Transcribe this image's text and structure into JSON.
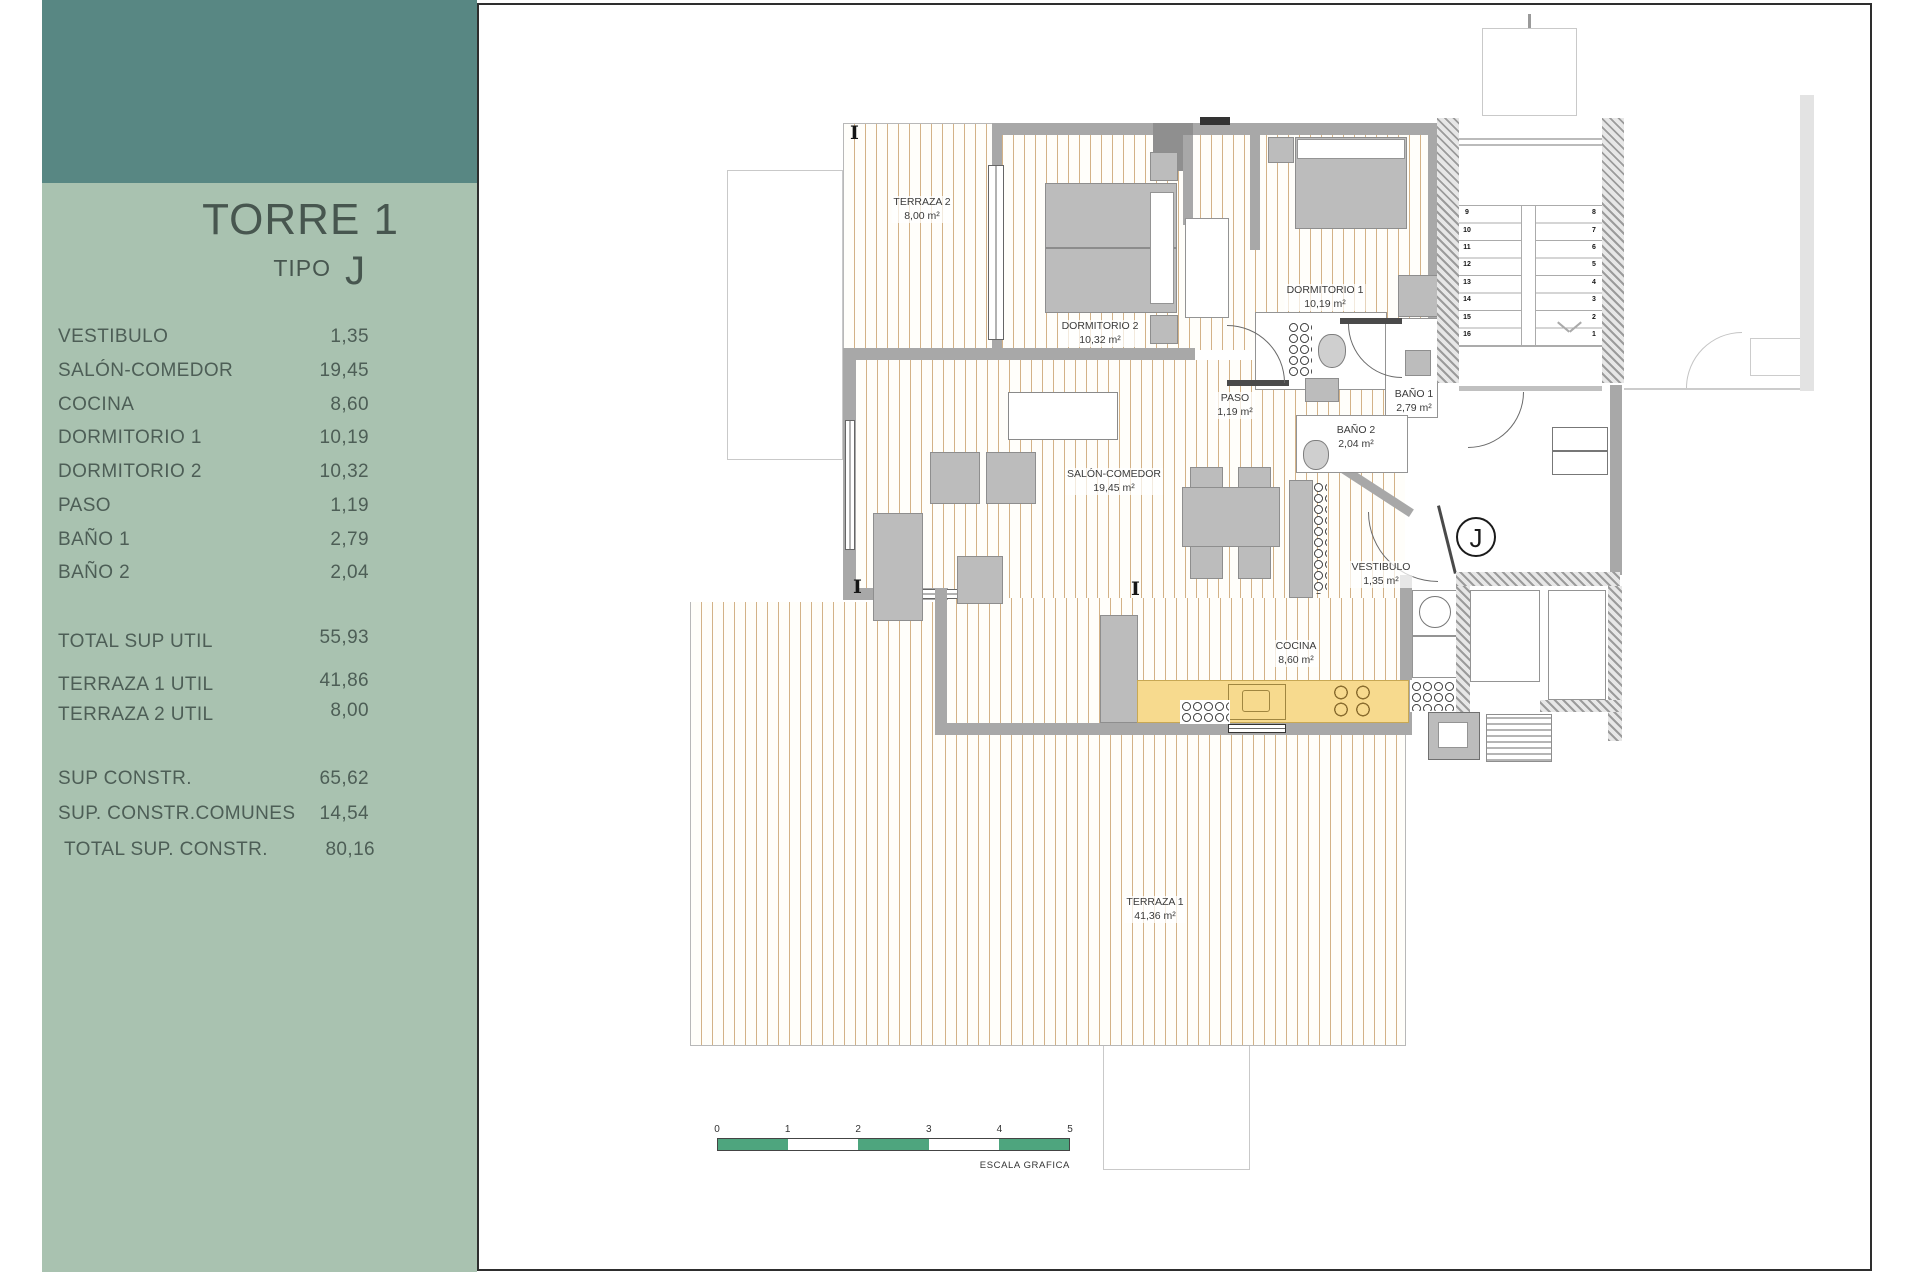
{
  "colors": {
    "sidebar_header": "#588783",
    "sidebar_panel": "#a9c2b0",
    "scale_green": "#4ea57e",
    "kitchen_counter": "#f7da8e",
    "wall_gray": "#a8a8a8"
  },
  "sidebar": {
    "title": "TORRE 1",
    "tipo_label": "TIPO",
    "tipo_value": "J",
    "rows": [
      {
        "label": "VESTIBULO",
        "value": "1,35"
      },
      {
        "label": "SALÓN-COMEDOR",
        "value": "19,45"
      },
      {
        "label": "COCINA",
        "value": "8,60"
      },
      {
        "label": "DORMITORIO 1",
        "value": "10,19"
      },
      {
        "label": "DORMITORIO 2",
        "value": "10,32"
      },
      {
        "label": "PASO",
        "value": "1,19"
      },
      {
        "label": "BAÑO 1",
        "value": "2,79"
      },
      {
        "label": "BAÑO 2",
        "value": "2,04"
      }
    ],
    "totals": [
      {
        "label": "TOTAL SUP UTIL",
        "value": "55,93"
      },
      {
        "label": "TERRAZA 1 UTIL",
        "value": "41,86"
      },
      {
        "label": "TERRAZA 2 UTIL",
        "value": "8,00"
      }
    ],
    "constructed": [
      {
        "label": "SUP CONSTR.",
        "value": "65,62"
      },
      {
        "label": "SUP. CONSTR.COMUNES",
        "value": "14,54"
      },
      {
        "label": "TOTAL SUP. CONSTR.",
        "value": "80,16"
      }
    ]
  },
  "plan": {
    "unit_marker": "J",
    "room_labels": [
      {
        "name": "TERRAZA 2",
        "area": "8,00 m²"
      },
      {
        "name": "DORMITORIO 2",
        "area": "10,32 m²"
      },
      {
        "name": "DORMITORIO 1",
        "area": "10,19 m²"
      },
      {
        "name": "PASO",
        "area": "1,19 m²"
      },
      {
        "name": "BAÑO 1",
        "area": "2,79 m²"
      },
      {
        "name": "BAÑO 2",
        "area": "2,04 m²"
      },
      {
        "name": "SALÓN-COMEDOR",
        "area": "19,45 m²"
      },
      {
        "name": "VESTIBULO",
        "area": "1,35 m²"
      },
      {
        "name": "COCINA",
        "area": "8,60 m²"
      },
      {
        "name": "TERRAZA 1",
        "area": "41,36 m²"
      }
    ],
    "stairs": {
      "left": [
        "9",
        "10",
        "11",
        "12",
        "13",
        "14",
        "15",
        "16"
      ],
      "right": [
        "8",
        "7",
        "6",
        "5",
        "4",
        "3",
        "2",
        "1"
      ]
    },
    "scale": {
      "ticks": [
        "0",
        "1",
        "2",
        "3",
        "4",
        "5"
      ],
      "caption": "ESCALA GRAFICA"
    }
  }
}
